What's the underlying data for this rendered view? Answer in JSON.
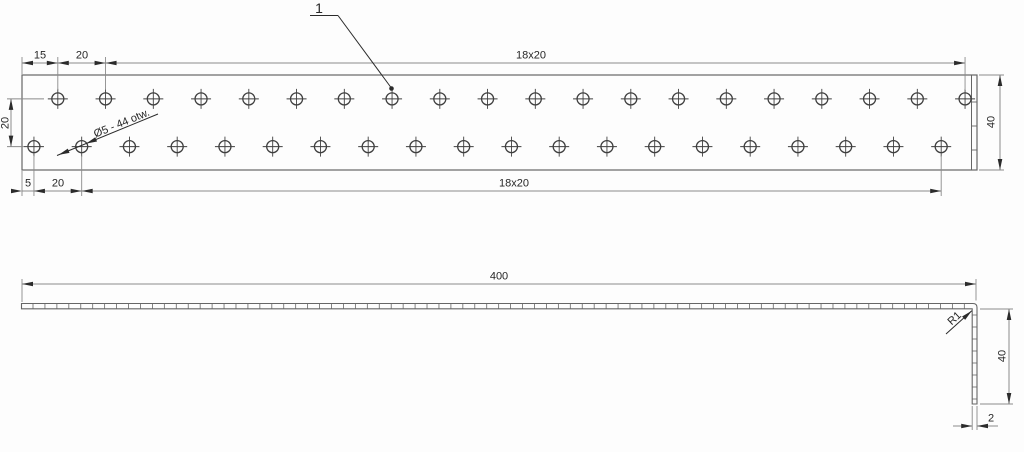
{
  "callout": {
    "label": "1"
  },
  "front_view": {
    "dim_top_first": "15",
    "dim_top_second": "20",
    "dim_top_span": "18x20",
    "dim_row_spacing": "20",
    "dim_height": "40",
    "dim_bottom_first": "5",
    "dim_bottom_second": "20",
    "dim_bottom_span": "18x20",
    "hole_note": "Ø5 - 44 otw.",
    "plate": {
      "length_mm": 400,
      "height_mm": 40
    },
    "holes": {
      "pitch_mm": 20,
      "rows": [
        {
          "name": "top",
          "count": 20,
          "first_offset_mm": 15,
          "y_mm": 10
        },
        {
          "name": "bottom",
          "count": 20,
          "first_offset_mm": 5,
          "y_mm": 30
        }
      ]
    }
  },
  "side_view": {
    "dim_length": "400",
    "dim_bend_radius": "R1",
    "dim_leg_height": "40",
    "dim_thickness": "2"
  },
  "colors": {
    "background": "#fdfdfd",
    "geometry": "#666666",
    "dimension": "#8a8a8a",
    "hole": "#3f3f3f",
    "accent": "#2b2b2b"
  }
}
